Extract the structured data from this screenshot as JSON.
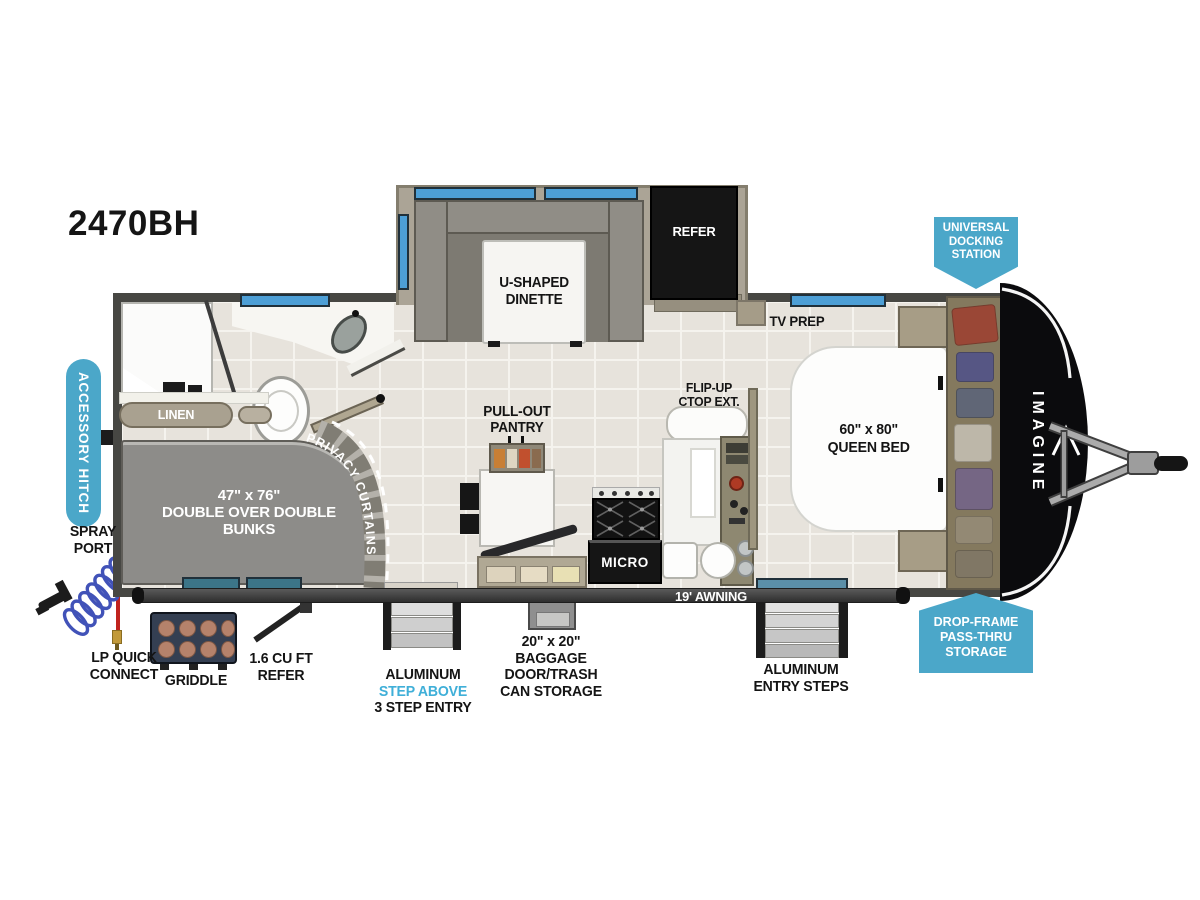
{
  "model": "2470BH",
  "colors": {
    "badge_blue": "#4BA7C9",
    "step_above_blue": "#3FAFD8",
    "window_blue": "#4D9FD6"
  },
  "callouts": {
    "universal_docking_station": "UNIVERSAL\nDOCKING\nSTATION",
    "drop_frame_pass_thru_storage": "DROP-FRAME\nPASS-THRU\nSTORAGE",
    "accessory_hitch": "ACCESSORY HITCH"
  },
  "exterior": {
    "spray_port": "SPRAY\nPORT",
    "lp_quick_connect": "LP QUICK\nCONNECT",
    "griddle": "GRIDDLE",
    "outside_refer": "1.6 CU FT\nREFER",
    "entry_steps_line1": "ALUMINUM",
    "entry_steps_line2": "STEP ABOVE",
    "entry_steps_line3": "3 STEP ENTRY",
    "baggage_storage": "20\" x 20\"\nBAGGAGE\nDOOR/TRASH\nCAN STORAGE",
    "awning": "19' AWNING",
    "bedroom_entry_steps": "ALUMINUM\nENTRY STEPS",
    "brand_front_cap": "IMAGINE"
  },
  "interior": {
    "dinette": "U-SHAPED\nDINETTE",
    "refer": "REFER",
    "tv_prep": "TV PREP",
    "queen_bed": "60\" x 80\"\nQUEEN BED",
    "flip_up_ctop": "FLIP-UP\nCTOP EXT.",
    "pull_out_pantry": "PULL-OUT\nPANTRY",
    "micro": "MICRO",
    "linen": "LINEN",
    "bunks": "47\" x 76\"\nDOUBLE OVER DOUBLE\nBUNKS",
    "privacy_curtains": "PRIVACY CURTAINS"
  }
}
